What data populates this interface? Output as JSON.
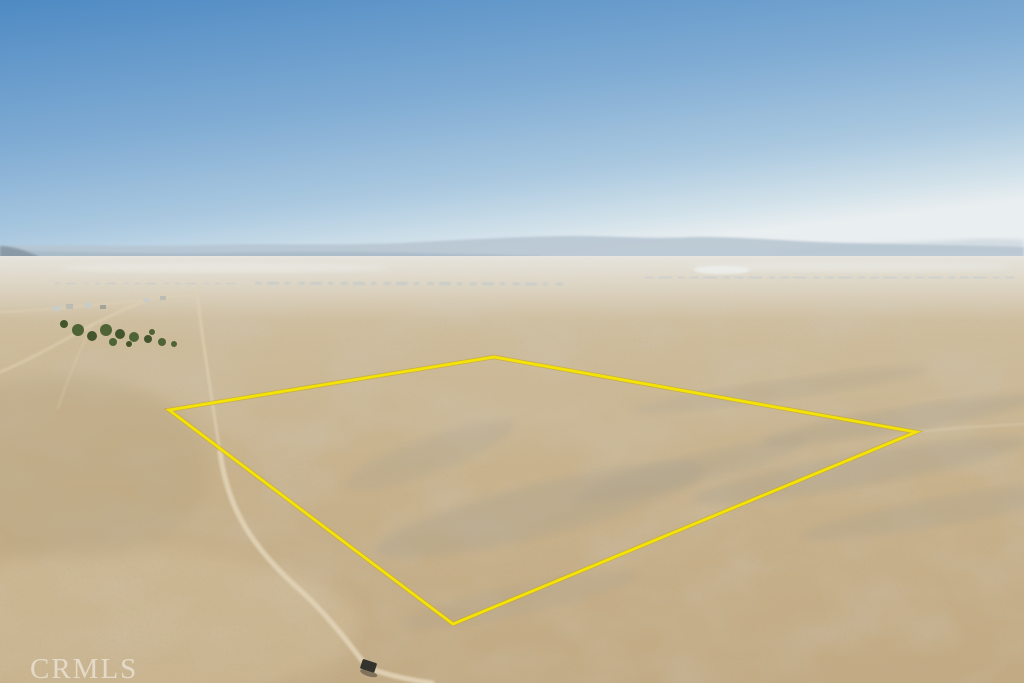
{
  "meta": {
    "type": "aerial-drone-photograph",
    "subject": "Vacant desert land parcel with surveyed property boundary overlay, distant town and mountains at horizon",
    "width_px": 1024,
    "height_px": 683
  },
  "watermark": {
    "text": "CRMLS",
    "color": "#ffffff",
    "opacity": 0.5
  },
  "boundary": {
    "label": "property-boundary-outline",
    "points": "169,410 494,357 916,432 453,624",
    "color": "#f4e307",
    "underlay_color": "#c9a50a",
    "stroke_width": 2.8
  },
  "sky": {
    "top_color": "#4e8ac3",
    "upper_color": "#7fabd3",
    "lower_color": "#abc9e0",
    "haze_color": "#d3e2ea",
    "horizon_color": "#e9eef0"
  },
  "mountains": {
    "far_color": "#b6c5d1",
    "near_color": "#a3b4c2",
    "left_hill_color": "#8796a3",
    "right_far_color": "#c2cfd8"
  },
  "terrain": {
    "distant_color": "#d7ccb5",
    "mid_color": "#cdbb9a",
    "near_color": "#c7b18b",
    "bottom_color": "#c2aa83",
    "wash_color": "#a49e8f",
    "road_color": "#e0d2b5",
    "drylake_color": "#e8e4d8"
  },
  "town": {
    "color": "#9fadb8",
    "glint_color": "#eef1ee"
  },
  "vegetation": {
    "tree_color": "#4f6436",
    "tree_dark_color": "#43552c"
  },
  "vehicle": {
    "color": "#34322c",
    "transform": "translate(369,666) rotate(18)"
  }
}
